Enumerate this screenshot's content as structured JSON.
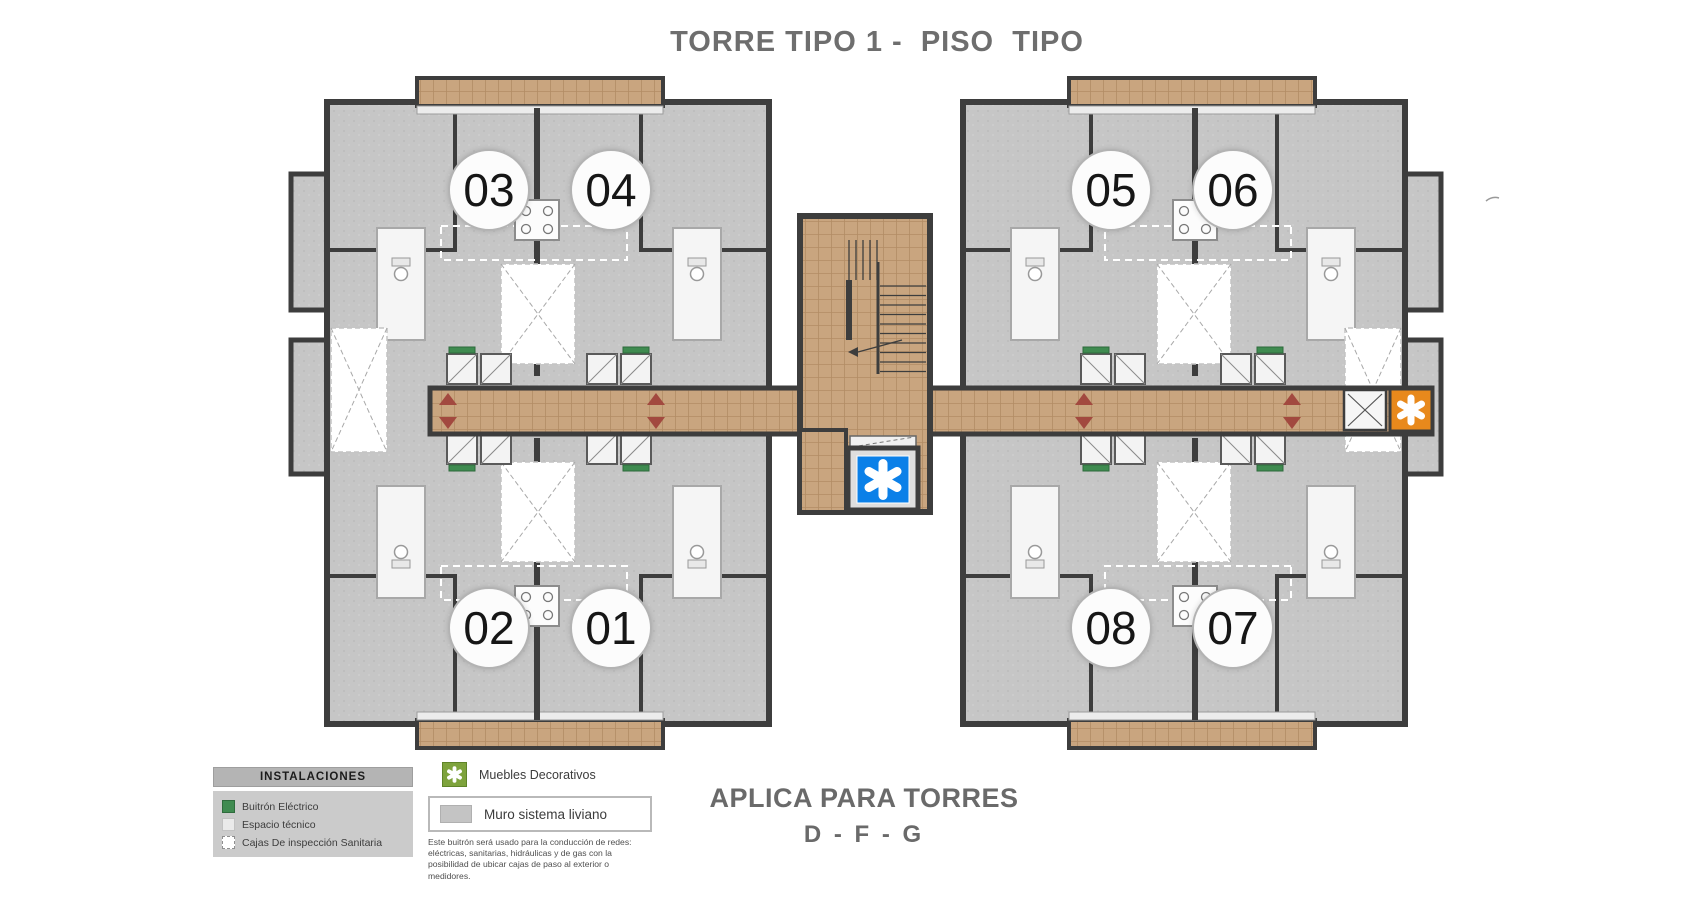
{
  "title": "TORRE TIPO 1 -  PISO  TIPO",
  "plan": {
    "units": [
      "03",
      "04",
      "05",
      "06",
      "02",
      "01",
      "08",
      "07"
    ],
    "markers": [
      {
        "name": "elevator-asterisk",
        "color_key": "blue"
      },
      {
        "name": "corridor-asterisk",
        "color_key": "orange"
      }
    ]
  },
  "legend": {
    "header": "INSTALACIONES",
    "items": [
      {
        "label": "Buitrón Eléctrico",
        "swatch": "#3f8b50"
      },
      {
        "label": "Espacio técnico",
        "swatch": "#eaeaea"
      },
      {
        "label": "Cajas De inspección Sanitaria",
        "swatch": "#ffffff"
      }
    ],
    "muebles_label": "Muebles Decorativos",
    "muro_label": "Muro sistema liviano",
    "note": "Este buitrón será usado para la conducción de redes: eléctricas, sanitarias, hidráulicas y de gas con la posibilidad de ubicar cajas de paso al exterior o medidores."
  },
  "footer": {
    "line1": "APLICA PARA TORRES",
    "line2": "D - F - G"
  },
  "colors": {
    "blue": "#0b80e8",
    "orange": "#e8891c",
    "green": "#3f8b50",
    "symbol_green": "#7ea33c",
    "tan": "#c9a57f",
    "grout": "#b28c64",
    "wall": "#3d3d3d",
    "concrete": "#c6c6c6",
    "red": "#a2493f",
    "text_gray": "#6e6e6e"
  }
}
